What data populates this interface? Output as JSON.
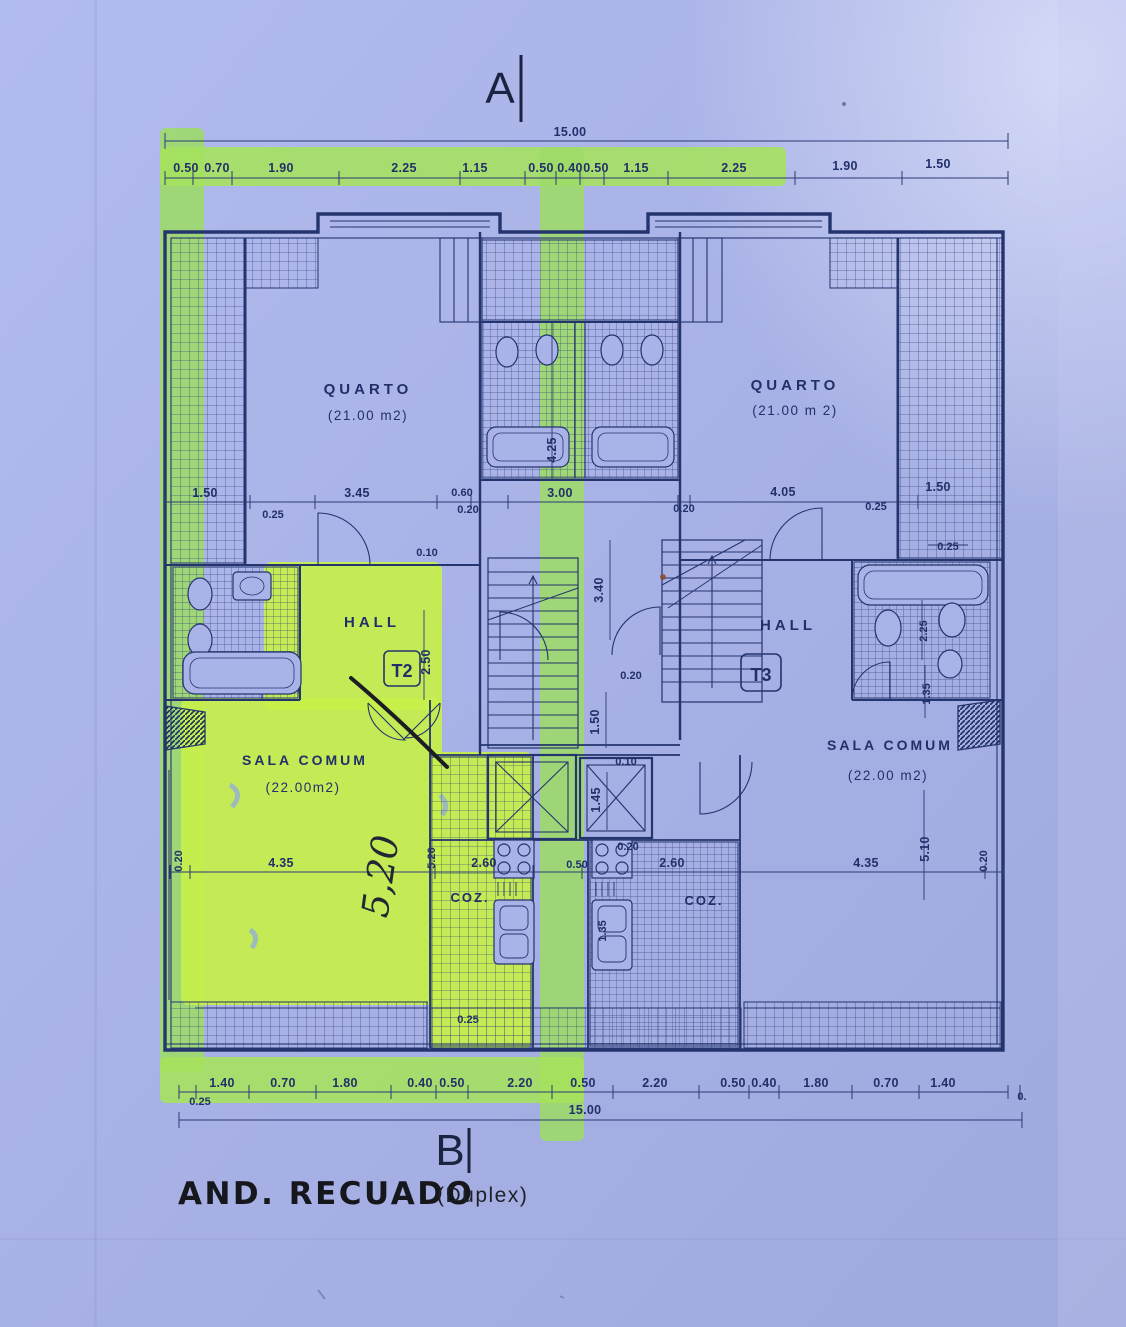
{
  "title_block": {
    "main": "AND. RECUADO",
    "suffix": "(Duplex)"
  },
  "section_markers": {
    "top": "A",
    "bottom": "B"
  },
  "rooms": {
    "quarto_left": {
      "name": "QUARTO",
      "area": "(21.00 m2)"
    },
    "quarto_right": {
      "name": "QUARTO",
      "area": "(21.00 m 2)"
    },
    "hall_left": {
      "name": "HALL",
      "unit_tag": "T2"
    },
    "hall_right": {
      "name": "HALL",
      "unit_tag": "T3"
    },
    "sala_left": {
      "name": "SALA COMUM",
      "area": "(22.00m2)"
    },
    "sala_right": {
      "name": "SALA COMUM",
      "area": "(22.00 m2)"
    },
    "coz_left": {
      "name": "COZ."
    },
    "coz_right": {
      "name": "COZ."
    }
  },
  "handwriting": {
    "note": "5,20"
  },
  "dims": {
    "overall_top": "15.00",
    "overall_bottom": "15.00",
    "top": [
      "0.50",
      "0.70",
      "1.90",
      "2.25",
      "1.15",
      "0.50",
      "0.40",
      "0.50",
      "1.15",
      "2.25",
      "1.90",
      "1.50"
    ],
    "mid": [
      "1.50",
      "0.25",
      "3.45",
      "0.60",
      "0.20",
      "3.00",
      "0.10",
      "0.20",
      "4.05",
      "0.25",
      "1.50",
      "0.25"
    ],
    "core": [
      "4.25",
      "3.40",
      "2.50",
      "0.20",
      "1.50",
      "0.10",
      "1.45"
    ],
    "right_bath": [
      "2.25",
      "1.35"
    ],
    "lower": [
      "0.20",
      "4.35",
      "5.20",
      "2.60",
      "0.50",
      "0.20",
      "2.60",
      "1.35",
      "4.35",
      "5.10",
      "0.20",
      "0.25"
    ],
    "bottom": [
      "1.40",
      "0.70",
      "1.80",
      "0.40",
      "0.50",
      "2.20",
      "0.50",
      "2.20",
      "0.50",
      "0.40",
      "1.80",
      "0.70",
      "1.40"
    ],
    "bottom_wall": "0.25",
    "bottom_right_cut": "0."
  },
  "colors": {
    "paper": "#a8b1e5",
    "ink": "#24346e",
    "highlight": "#c7f04a",
    "band": "#9ddb68",
    "pen": "#1c1d22"
  }
}
